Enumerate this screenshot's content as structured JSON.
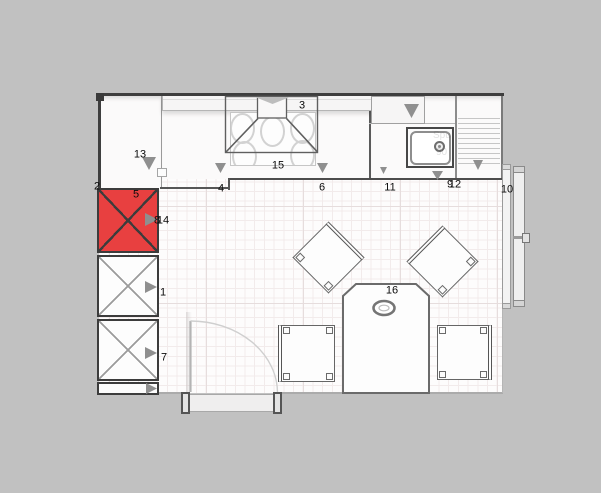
{
  "app": {
    "name": "kitchen-planner-floor-plan"
  },
  "selection": {
    "selected_item_number": "5",
    "selected_fill_color": "#e84040"
  },
  "item_labels": [
    {
      "text": "1",
      "x": 163,
      "y": 293
    },
    {
      "text": "2",
      "x": 97,
      "y": 187
    },
    {
      "text": "3",
      "x": 302,
      "y": 106
    },
    {
      "text": "4",
      "x": 221,
      "y": 189
    },
    {
      "text": "5",
      "x": 136,
      "y": 195
    },
    {
      "text": "6",
      "x": 322,
      "y": 188
    },
    {
      "text": "7",
      "x": 164,
      "y": 358
    },
    {
      "text": "8",
      "x": 157,
      "y": 221
    },
    {
      "text": "9",
      "x": 450,
      "y": 185
    },
    {
      "text": "10",
      "x": 507,
      "y": 190
    },
    {
      "text": "11",
      "x": 390,
      "y": 188
    },
    {
      "text": "12",
      "x": 455,
      "y": 185
    },
    {
      "text": "13",
      "x": 140,
      "y": 155
    },
    {
      "text": "14",
      "x": 163,
      "y": 221
    },
    {
      "text": "15",
      "x": 278,
      "y": 166
    },
    {
      "text": "16",
      "x": 392,
      "y": 291
    }
  ],
  "arrow_icons": [
    {
      "name": "open-direction-right-arrow-icon",
      "dir": "right",
      "x": 145,
      "y": 213,
      "w": 13,
      "h": 13
    },
    {
      "name": "open-direction-right-arrow-icon",
      "dir": "right",
      "x": 145,
      "y": 281,
      "w": 12,
      "h": 12
    },
    {
      "name": "open-direction-right-arrow-icon",
      "dir": "right",
      "x": 145,
      "y": 347,
      "w": 12,
      "h": 12
    },
    {
      "name": "open-direction-right-arrow-icon",
      "dir": "right",
      "x": 146,
      "y": 383,
      "w": 11,
      "h": 11
    },
    {
      "name": "open-direction-down-arrow-icon",
      "dir": "down",
      "x": 142,
      "y": 157,
      "w": 14,
      "h": 13
    },
    {
      "name": "open-direction-down-arrow-icon",
      "dir": "down",
      "x": 215,
      "y": 163,
      "w": 11,
      "h": 10
    },
    {
      "name": "open-direction-down-arrow-icon",
      "dir": "down",
      "x": 317,
      "y": 163,
      "w": 11,
      "h": 10
    },
    {
      "name": "open-direction-down-arrow-icon",
      "dir": "down",
      "x": 404,
      "y": 104,
      "w": 15,
      "h": 14
    },
    {
      "name": "open-direction-down-arrow-icon",
      "dir": "down",
      "x": 432,
      "y": 171,
      "w": 11,
      "h": 9
    },
    {
      "name": "open-direction-down-arrow-icon",
      "dir": "down",
      "x": 473,
      "y": 160,
      "w": 10,
      "h": 10
    },
    {
      "name": "open-direction-down-arrow-icon",
      "dir": "down",
      "x": 380,
      "y": 167,
      "w": 7,
      "h": 7
    },
    {
      "name": "hood-vent-arrow-icon",
      "dir": "down",
      "x": 255,
      "y": 97,
      "w": 35,
      "h": 7,
      "color": "#bdbdbd"
    }
  ],
  "ghost_labels": [
    {
      "text": "Spü",
      "x": 433,
      "y": 131
    },
    {
      "text": "90",
      "x": 436,
      "y": 148
    }
  ],
  "colors": {
    "bg": "#c1c1c1",
    "wall": "#3e3e3e",
    "outline": "#555555",
    "arrow": "#8f8f8f",
    "selected_red": "#e84040",
    "floor": "#fdfcfc",
    "grid_minor": "#f2ebeb",
    "grid_major": "#e6dddd"
  }
}
